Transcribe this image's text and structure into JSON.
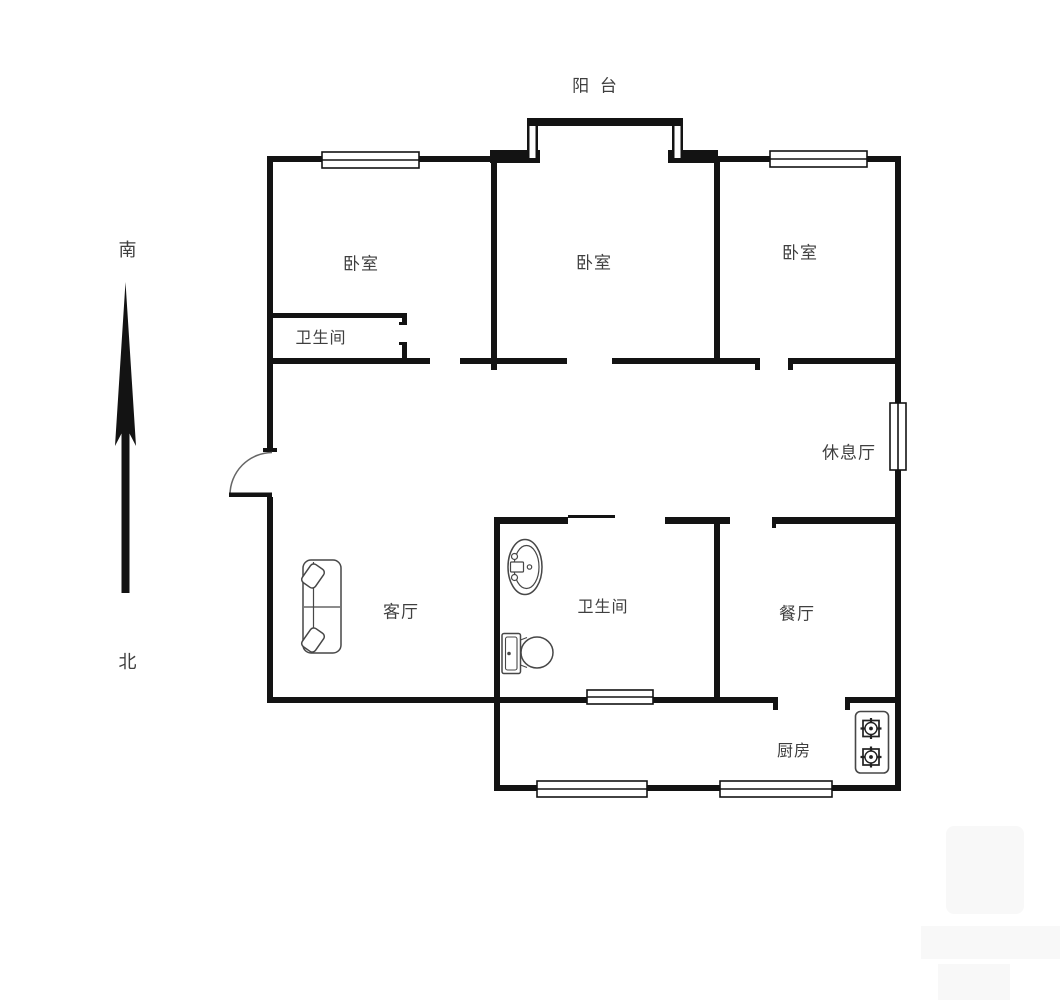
{
  "page": {
    "background": "#ffffff"
  },
  "colors": {
    "wall": "#131313",
    "fixture": "#474747",
    "label": "#3f3f3f",
    "watermark": "#f8f8f8"
  },
  "compass": {
    "south": "南",
    "north": "北"
  },
  "rooms": {
    "balcony": "阳 台",
    "bedroom_left": "卧室",
    "bedroom_middle": "卧室",
    "bedroom_right": "卧室",
    "bathroom_upper": "卫生间",
    "lounge": "休息厅",
    "living_room": "客厅",
    "bathroom_lower": "卫生间",
    "dining_room": "餐厅",
    "kitchen": "厨房"
  },
  "fixtures": {
    "entry_door": "entry-door-swing",
    "sofa": "two-seat-sofa",
    "wash_basin": "wash-basin",
    "toilet": "toilet",
    "gas_stove": "two-burner-gas-stove",
    "compass_arrow": "south-north-arrow",
    "windows_count": 6
  }
}
